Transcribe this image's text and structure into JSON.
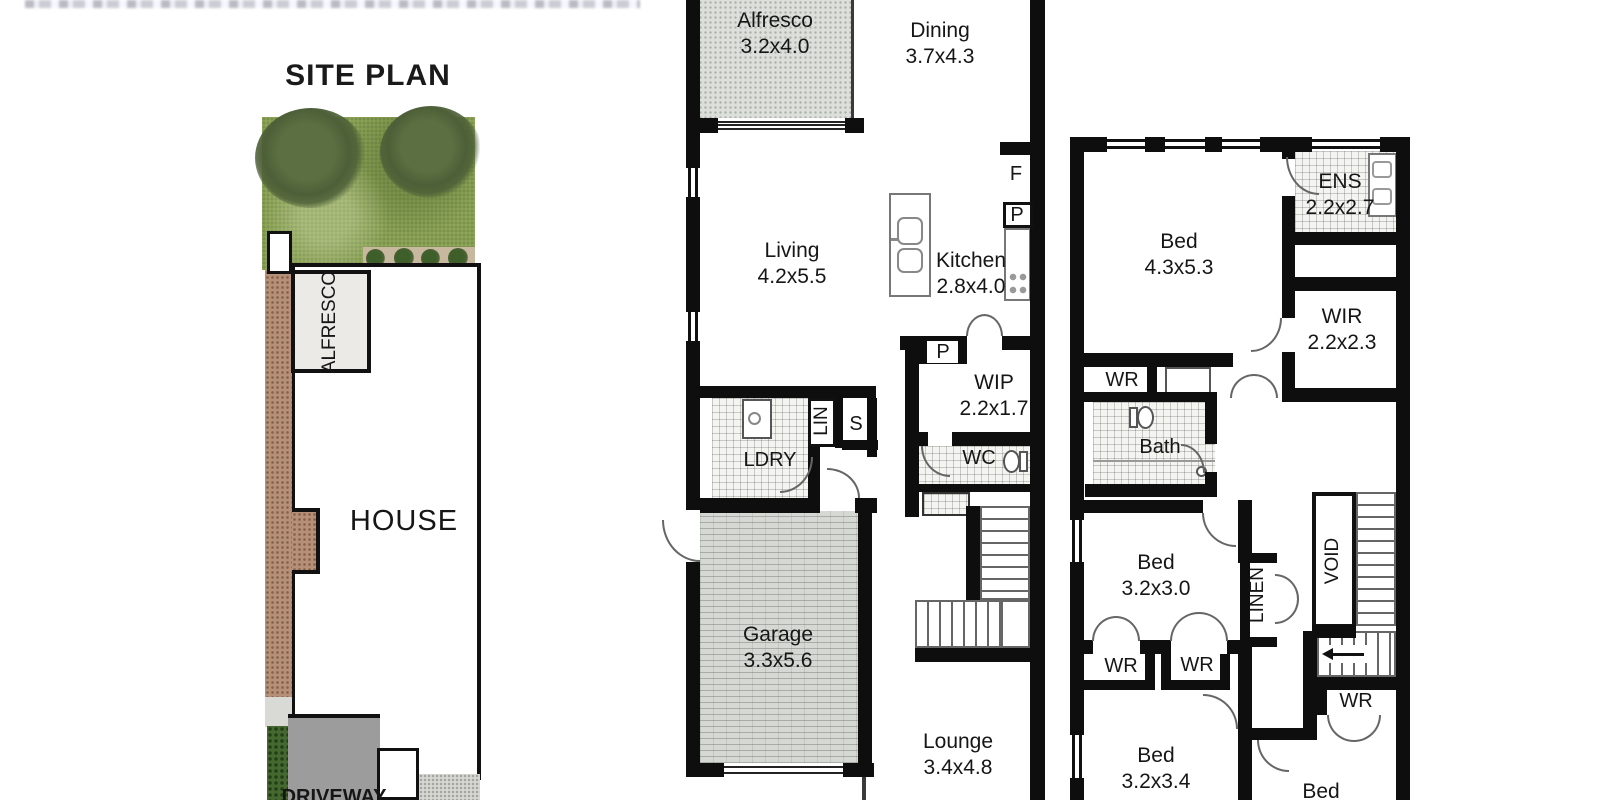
{
  "site_plan": {
    "title": "SITE PLAN",
    "alfresco": "ALFRESCO",
    "house": "HOUSE",
    "driveway": "DRIVEWAY"
  },
  "ground_floor": {
    "alfresco": {
      "name": "Alfresco",
      "dims": "3.2x4.0"
    },
    "dining": {
      "name": "Dining",
      "dims": "3.7x4.3"
    },
    "living": {
      "name": "Living",
      "dims": "4.2x5.5"
    },
    "kitchen": {
      "name": "Kitchen",
      "dims": "2.8x4.0"
    },
    "fridge": "F",
    "pantry": "P",
    "pantry2": "P",
    "wip": {
      "name": "WIP",
      "dims": "2.2x1.7"
    },
    "wc": "WC",
    "laundry": "LDRY",
    "linen": "LIN",
    "store": "S",
    "garage": {
      "name": "Garage",
      "dims": "3.3x5.6"
    },
    "lounge": {
      "name": "Lounge",
      "dims": "3.4x4.8"
    }
  },
  "first_floor": {
    "bed1": {
      "name": "Bed",
      "dims": "4.3x5.3"
    },
    "ens": {
      "name": "ENS",
      "dims": "2.2x2.7"
    },
    "wir": {
      "name": "WIR",
      "dims": "2.2x2.3"
    },
    "wr_bed1": "WR",
    "bath": "Bath",
    "bed2": {
      "name": "Bed",
      "dims": "3.2x3.0"
    },
    "linen": "LINEN",
    "void": "VOID",
    "wr_bed2_a": "WR",
    "wr_bed2_b": "WR",
    "bed3": {
      "name": "Bed",
      "dims": "3.2x3.4"
    },
    "wr_bed4": "WR",
    "bed4": {
      "name": "Bed"
    }
  },
  "colors": {
    "wall": "#0e0e0e",
    "paved_area": "#dde0da",
    "garage_floor": "#d6d9d3",
    "tile_grid": "#c9c9c9",
    "grass": "#8fa659",
    "tree_foliage": "#4d5f37",
    "mulch": "#b69079",
    "driveway": "#9c9c9c",
    "hedge": "#44682f",
    "gravel": "#d7d7d3"
  }
}
